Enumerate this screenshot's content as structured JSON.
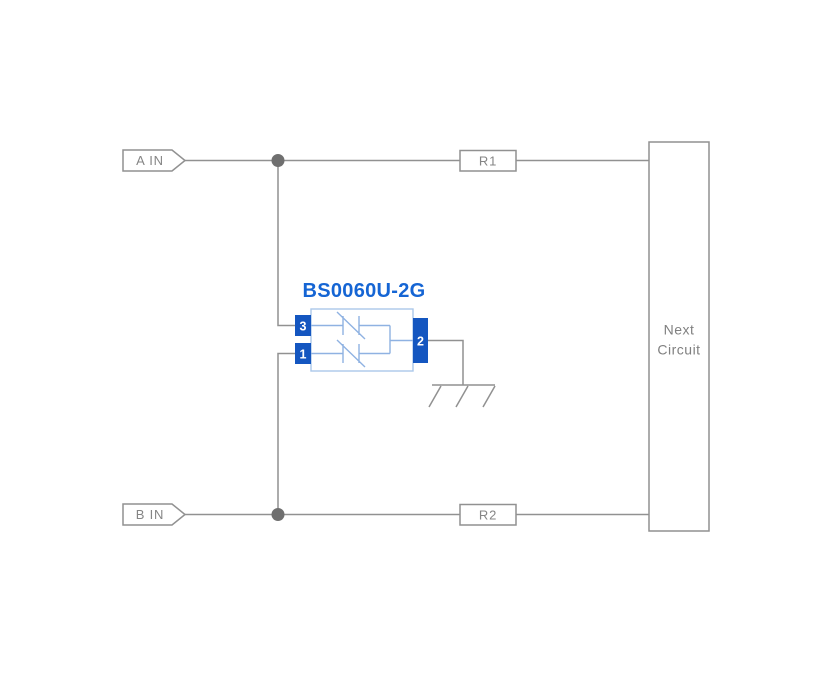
{
  "diagram": {
    "component": {
      "part_number": "BS0060U-2G",
      "pins": [
        "3",
        "1",
        "2"
      ]
    },
    "terminals": {
      "a": "A IN",
      "b": "B IN"
    },
    "resistors": {
      "r1": "R1",
      "r2": "R2"
    },
    "next_circuit": {
      "line1": "Next",
      "line2": "Circuit"
    },
    "colors": {
      "accent_blue": "#1565d4",
      "pin_blue": "#1456c0",
      "body_border_blue": "#abc8ea",
      "inner_wire_blue": "#8fb2e2",
      "wire_gray": "#919191",
      "text_gray": "#858585",
      "junction_gray": "#6f6f6f",
      "background": "#ffffff"
    }
  }
}
